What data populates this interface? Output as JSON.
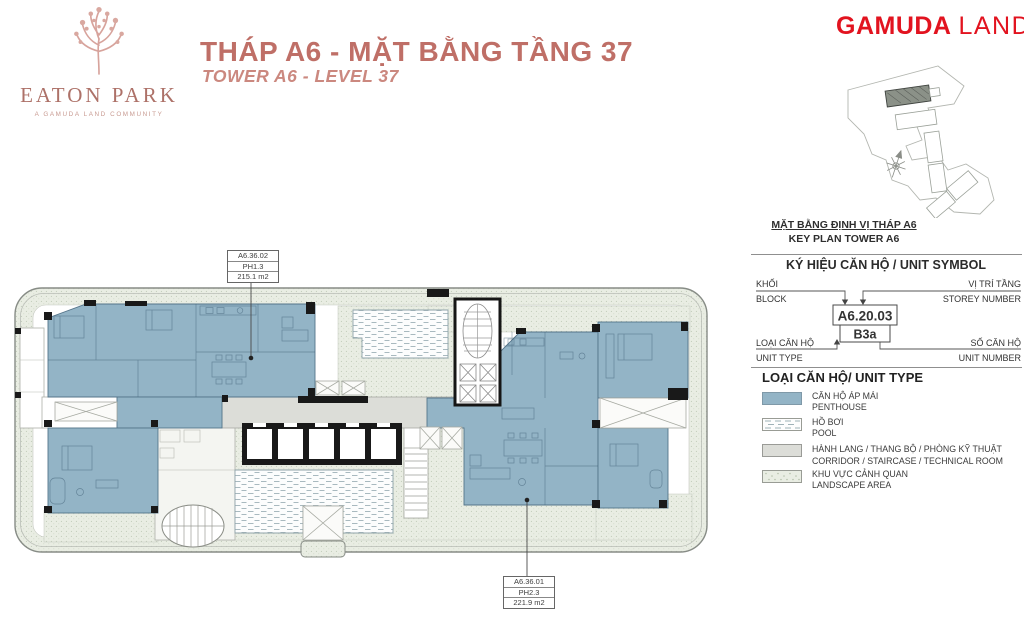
{
  "header": {
    "title_vi": "THÁP A6 - MẶT BẰNG TẦNG 37",
    "title_en": "TOWER A6 - LEVEL 37",
    "eaton": {
      "name": "EATON PARK",
      "tagline": "A GAMUDA LAND COMMUNITY"
    },
    "gamuda": {
      "word1": "GAMUDA",
      "word2": "LAND"
    }
  },
  "plan": {
    "unit_labels": [
      {
        "code": "A6.36.02",
        "type": "PH1.3",
        "area": "215.1 m2"
      },
      {
        "code": "A6.36.01",
        "type": "PH2.3",
        "area": "221.9 m2"
      }
    ]
  },
  "sidebar": {
    "keyplan_caption_vi": "MẶT BẰNG ĐỊNH VỊ THÁP A6",
    "keyplan_caption_en": "KEY PLAN TOWER A6",
    "symbol": {
      "title": "KÝ HIỆU CĂN HỘ / UNIT SYMBOL",
      "block_vi": "KHỐI",
      "block_en": "BLOCK",
      "storey_vi": "VỊ TRÍ TẦNG",
      "storey_en": "STOREY NUMBER",
      "type_vi": "LOẠI CĂN HỘ",
      "type_en": "UNIT TYPE",
      "number_vi": "SỐ CĂN HỘ",
      "number_en": "UNIT NUMBER",
      "sample_code": "A6.20.03",
      "sample_type": "B3a"
    },
    "legend": {
      "title": "LOẠI CĂN HỘ/ UNIT TYPE",
      "items": [
        {
          "vi": "CĂN HỘ ÁP MÁI",
          "en": "PENTHOUSE",
          "swatch": "penthouse"
        },
        {
          "vi": "HỒ BƠI",
          "en": "POOL",
          "swatch": "pool"
        },
        {
          "vi": "HÀNH LANG / THANG BỘ / PHÒNG KỸ THUẬT",
          "en": "CORRIDOR / STAIRCASE / TECHNICAL ROOM",
          "swatch": "corridor"
        },
        {
          "vi": "KHU VỰC CẢNH QUAN",
          "en": "LANDSCAPE AREA",
          "swatch": "landscape"
        }
      ]
    }
  },
  "colors": {
    "accent": "#bf6f67",
    "brand_red": "#e2131f",
    "penthouse_blue": "#93b4c6",
    "corridor_gray": "#dcddd8",
    "landscape_green": "#e9ede3",
    "pool_dash": "#9fb2b8"
  }
}
